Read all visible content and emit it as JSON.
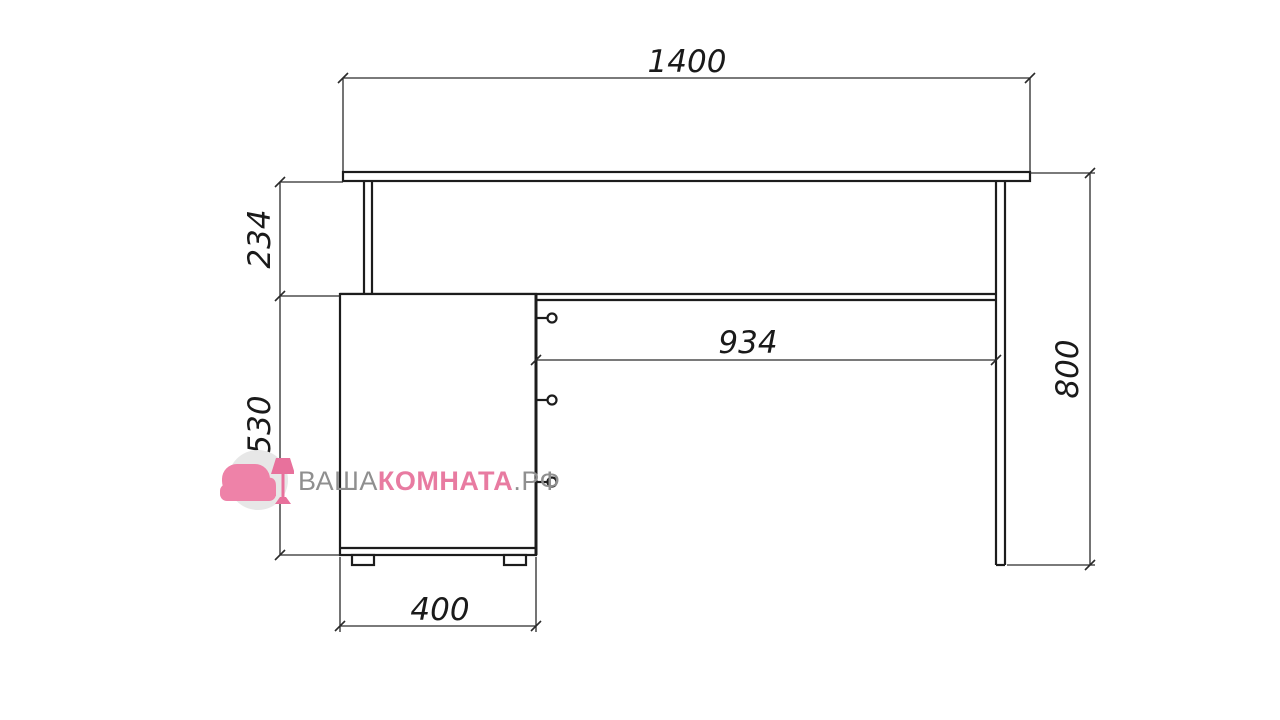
{
  "diagram": {
    "type": "furniture-dimension-drawing",
    "subject": "writing desk with drawer cabinet and side panel, front elevation",
    "units": "mm",
    "line_color": "#1c1c1c",
    "background": "#ffffff",
    "dimensions": {
      "total_width": "1400",
      "under_top_clearance": "234",
      "cabinet_height": "530",
      "cabinet_width": "400",
      "knee_space_width": "934",
      "total_height": "800"
    },
    "parts": {
      "desktop": "table top",
      "left_leg": "left support leg",
      "cabinet": "three-drawer cabinet with knobs and two feet",
      "right_panel": "right side panel",
      "back_rail": "rail under desktop"
    }
  },
  "watermark": {
    "brand_part_gray_1": "ВАША",
    "brand_part_pink": "КОМНАТА",
    "brand_part_gray_2": ".РФ",
    "gray_color": "#8f8f8f",
    "pink_color": "#e87ba1",
    "icon": "armchair-and-lamp-logo"
  }
}
